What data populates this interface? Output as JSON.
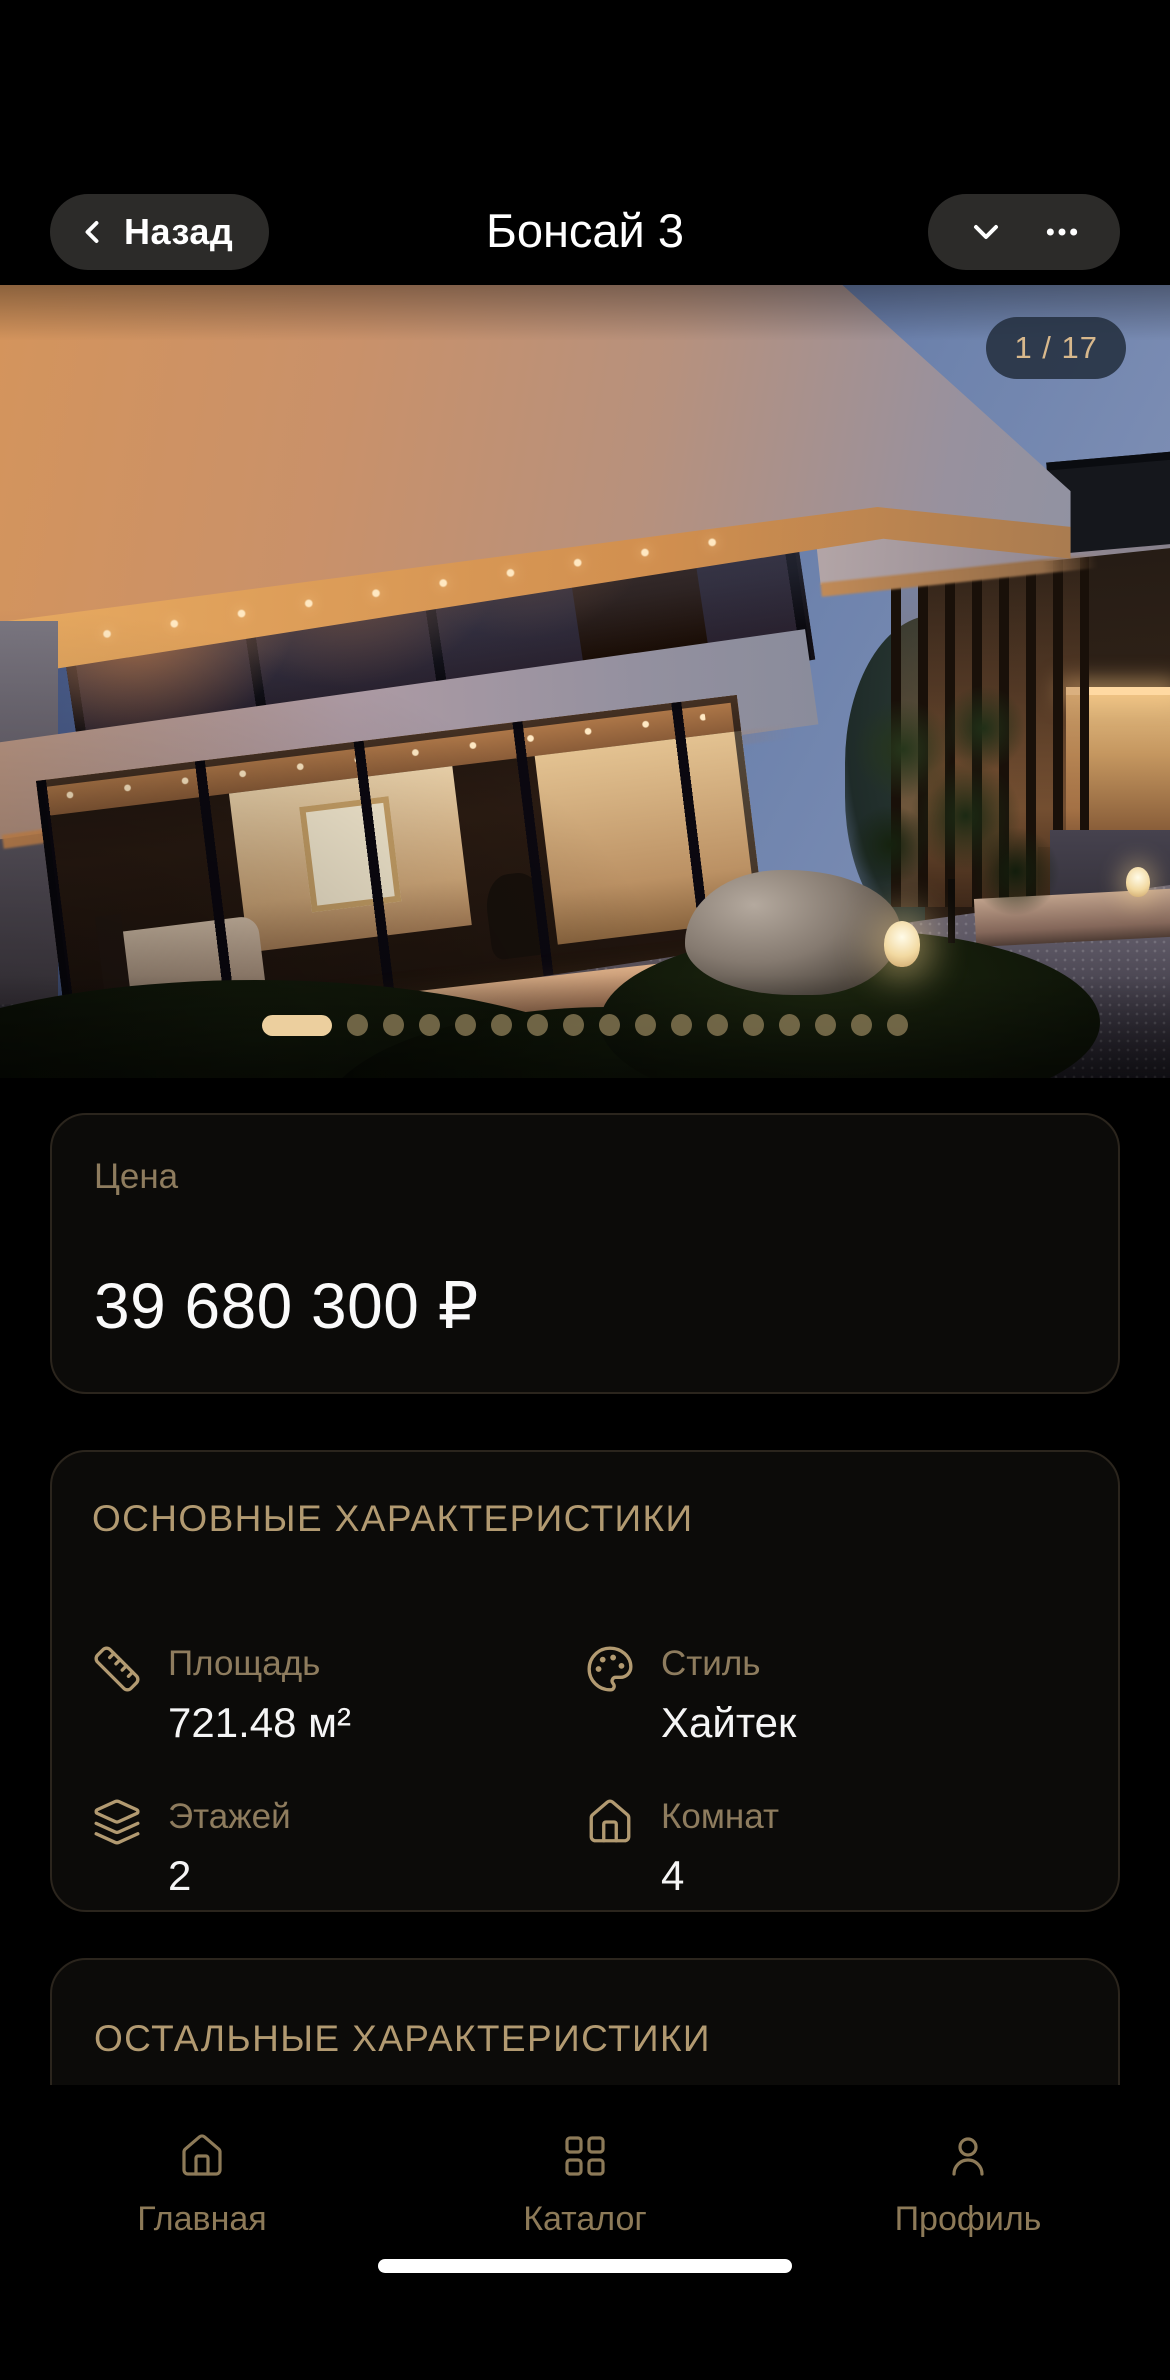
{
  "header": {
    "back_label": "Назад",
    "title": "Бонсай 3"
  },
  "gallery": {
    "counter": "1 / 17",
    "total_dots": 17,
    "active_dot": 0
  },
  "price_card": {
    "label": "Цена",
    "value": "39 680 300 ₽"
  },
  "main_specs": {
    "title": "ОСНОВНЫЕ ХАРАКТЕРИСТИКИ",
    "items": [
      {
        "icon": "ruler-icon",
        "label": "Площадь",
        "value": "721.48 м²"
      },
      {
        "icon": "palette-icon",
        "label": "Стиль",
        "value": "Хайтек"
      },
      {
        "icon": "layers-icon",
        "label": "Этажей",
        "value": "2"
      },
      {
        "icon": "house-icon",
        "label": "Комнат",
        "value": "4"
      }
    ]
  },
  "other_specs": {
    "title": "ОСТАЛЬНЫЕ ХАРАКТЕРИСТИКИ"
  },
  "tab_bar": {
    "items": [
      {
        "icon": "house-icon",
        "label": "Главная"
      },
      {
        "icon": "grid-icon",
        "label": "Каталог"
      },
      {
        "icon": "user-icon",
        "label": "Профиль"
      }
    ]
  },
  "colors": {
    "accent_gold": "#b29a71",
    "muted_gold": "#8e7c5e",
    "badge_text": "#d8b88c",
    "active_dot": "#eccf9e",
    "inactive_dot": "#8c7c57",
    "card_background": "#0c0b09",
    "card_border": "#2b251d",
    "page_background": "#000000"
  }
}
